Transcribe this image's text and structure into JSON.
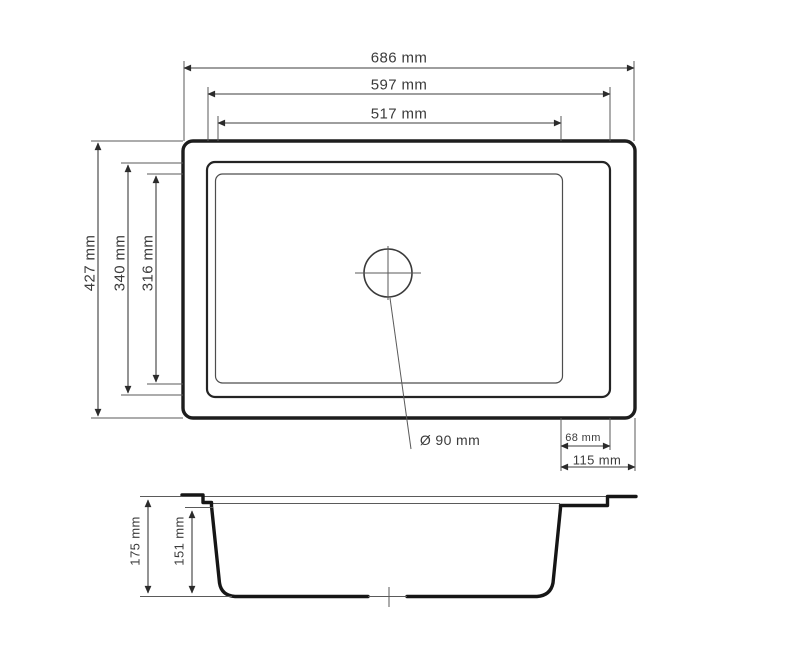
{
  "drawing": {
    "type": "kitchen-sink-technical-drawing",
    "views": {
      "top_view": {
        "dims": {
          "outer_width": "686 mm",
          "rim_width": "597 mm",
          "bowl_width": "517 mm",
          "outer_depth": "427 mm",
          "rim_depth": "340 mm",
          "bowl_depth": "316 mm",
          "drain_diameter": "Ø 90 mm",
          "right_inset_rim": "68 mm",
          "right_inset_outer": "115 mm"
        }
      },
      "side_view": {
        "dims": {
          "total_height": "175 mm",
          "bowl_depth": "151 mm"
        }
      }
    },
    "colors": {
      "background": "#ffffff",
      "outline": "#1d1d1d",
      "thin_line": "#5a5a5a",
      "text": "#3b3b3b"
    }
  }
}
